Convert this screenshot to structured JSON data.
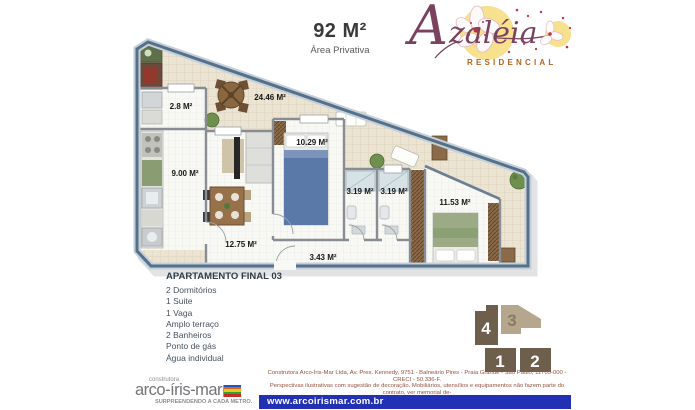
{
  "header": {
    "area": "92 M²",
    "area_label": "Área Privativa"
  },
  "brand": {
    "name_initial": "A",
    "name_rest": "zaléia",
    "subtitle": "RESIDENCIAL"
  },
  "plan": {
    "rooms": [
      {
        "name": "terraco",
        "area": "24.46 M²"
      },
      {
        "name": "servico",
        "area": "2.8 M²"
      },
      {
        "name": "cozinha",
        "area": "9.00 M²"
      },
      {
        "name": "dormitorio",
        "area": "10.29 M²"
      },
      {
        "name": "banheiro-1",
        "area": "3.19 M²"
      },
      {
        "name": "banheiro-2",
        "area": "3.19 M²"
      },
      {
        "name": "suite",
        "area": "11.53 M²"
      },
      {
        "name": "sala",
        "area": "12.75 M²"
      },
      {
        "name": "hall",
        "area": "3.43 M²"
      }
    ]
  },
  "details": {
    "title": "APARTAMENTO FINAL 03",
    "items": [
      "2 Dormitórios",
      "1 Suite",
      "1 Vaga",
      "Amplo terraço",
      "2 Banheiros",
      "Ponto de gás",
      "Água individual"
    ]
  },
  "units_diagram": {
    "units": [
      {
        "number": "4",
        "highlighted": false
      },
      {
        "number": "3",
        "highlighted": true
      },
      {
        "number": "1",
        "highlighted": false
      },
      {
        "number": "2",
        "highlighted": false
      }
    ]
  },
  "legal": {
    "lines": [
      "Construtora Arco-Íris-Mar Ltda, Av. Pres. Kennedy, 9751 - Balneário Pires - Praia Grande - São Paulo, 11705-000 - CRECI - 50.336-F.",
      "Perspectivas ilustrativas com sugestão de decoração. Mobiliários, utensílios e equipamentos não fazem parte do contrato, ver memorial de-",
      "scritivo. Material de consulta do corretor; o empreendimento só será comercializado após registro no cartório de imóveis."
    ]
  },
  "website": "www.arcoirismar.com.br",
  "builder": {
    "pre": "construtora",
    "name": "arco-íris-mar",
    "slogan": "SURPREENDENDO A CADA METRO."
  },
  "colors": {
    "brand_maroon": "#7b4260",
    "residencial_orange": "#b4641f",
    "website_bar_blue": "#2230b4",
    "legal_text_red": "#96503f",
    "wall_blue": "#56708a",
    "unit_block_dark": "#6e5f4d",
    "unit_block_highlight": "#b5a68e",
    "terrace_beige": "#ece4d3"
  }
}
